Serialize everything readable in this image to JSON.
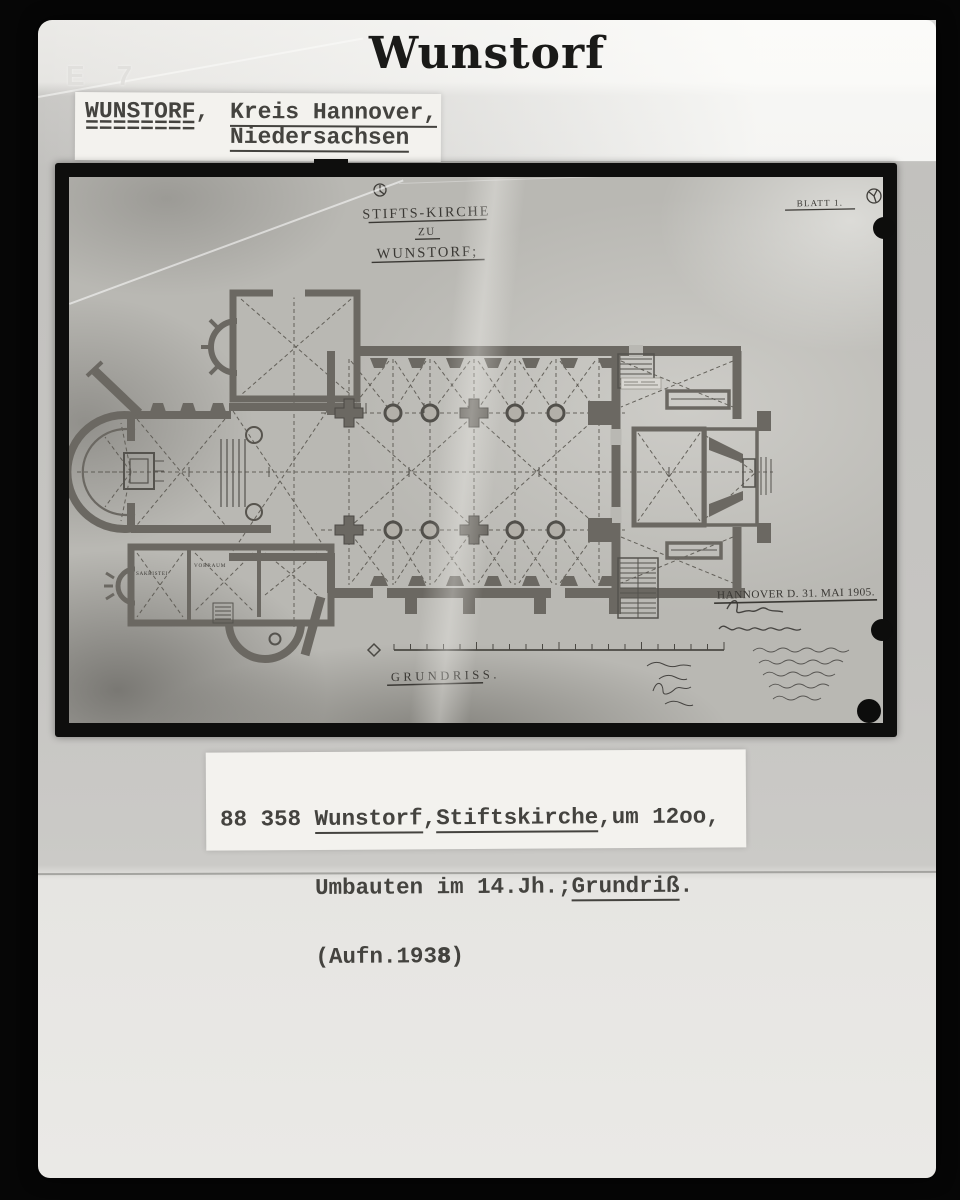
{
  "header": {
    "title": "Wunstorf",
    "shelf_mark": "E 7"
  },
  "location_label": {
    "town": "WUNSTORF,",
    "town_underline": "========",
    "district": "Kreis Hannover,",
    "state": "Niedersachsen"
  },
  "photo": {
    "plan_title": {
      "line1": "STIFTS-KIRCHE",
      "line2": "ZU",
      "line3": "WUNSTORF;"
    },
    "sheet_no": "BLATT 1.",
    "place_date": "HANNOVER D. 31. MAI 1905.",
    "drawing_type": "GRUNDRISS.",
    "rooms": {
      "sacristy": "SAKRISTEI",
      "vestibule": "VORRAUM"
    }
  },
  "caption": {
    "number": "88 358 ",
    "town": "Wunstorf",
    "sep1": ",",
    "building": "Stiftskirche",
    "line1_end": ",um 12oo,",
    "line2_plain": "Umbauten im 14.Jh.;",
    "line2_term": "Grundriß",
    "line2_end": ".",
    "line3_pre": "(Aufn.193",
    "line3_bold": "8",
    "line3_end": ")"
  },
  "colors": {
    "card": "#c5c4c1",
    "photo_background": "#b9b8b3",
    "plan_ink": "#4c4a45",
    "wall_gray": "#6b6862",
    "frame_black": "#0e0e0d"
  }
}
